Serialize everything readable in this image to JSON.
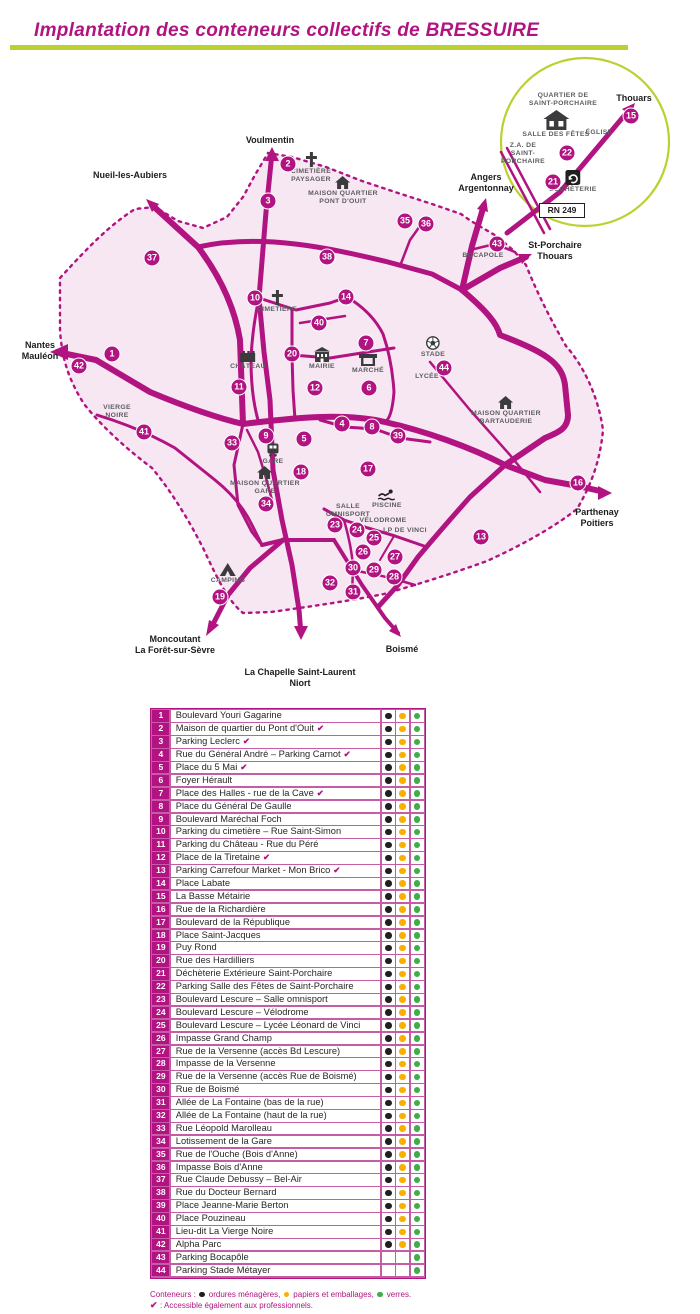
{
  "title": "Implantation des conteneurs collectifs de BRESSUIRE",
  "colors": {
    "magenta": "#b11380",
    "chartreuse": "#bcd02f",
    "pink": "#f6e7f2",
    "dot_black": "#231f20",
    "dot_yellow": "#f9b000",
    "dot_green": "#3fae49"
  },
  "map": {
    "markers": [
      {
        "n": 1,
        "x": 112,
        "y": 354
      },
      {
        "n": 2,
        "x": 288,
        "y": 164
      },
      {
        "n": 3,
        "x": 268,
        "y": 201
      },
      {
        "n": 4,
        "x": 342,
        "y": 424
      },
      {
        "n": 5,
        "x": 304,
        "y": 439
      },
      {
        "n": 6,
        "x": 369,
        "y": 388
      },
      {
        "n": 7,
        "x": 366,
        "y": 343
      },
      {
        "n": 8,
        "x": 372,
        "y": 427
      },
      {
        "n": 9,
        "x": 266,
        "y": 436
      },
      {
        "n": 10,
        "x": 255,
        "y": 298
      },
      {
        "n": 11,
        "x": 239,
        "y": 387
      },
      {
        "n": 12,
        "x": 315,
        "y": 388
      },
      {
        "n": 13,
        "x": 481,
        "y": 537
      },
      {
        "n": 14,
        "x": 346,
        "y": 297
      },
      {
        "n": 15,
        "x": 631,
        "y": 116
      },
      {
        "n": 16,
        "x": 578,
        "y": 483
      },
      {
        "n": 17,
        "x": 368,
        "y": 469
      },
      {
        "n": 18,
        "x": 301,
        "y": 472
      },
      {
        "n": 19,
        "x": 220,
        "y": 597
      },
      {
        "n": 20,
        "x": 292,
        "y": 354
      },
      {
        "n": 21,
        "x": 553,
        "y": 182
      },
      {
        "n": 22,
        "x": 567,
        "y": 153
      },
      {
        "n": 23,
        "x": 335,
        "y": 525
      },
      {
        "n": 24,
        "x": 357,
        "y": 530
      },
      {
        "n": 25,
        "x": 374,
        "y": 538
      },
      {
        "n": 26,
        "x": 363,
        "y": 552
      },
      {
        "n": 27,
        "x": 395,
        "y": 557
      },
      {
        "n": 28,
        "x": 394,
        "y": 577
      },
      {
        "n": 29,
        "x": 374,
        "y": 570
      },
      {
        "n": 30,
        "x": 353,
        "y": 568
      },
      {
        "n": 31,
        "x": 353,
        "y": 592
      },
      {
        "n": 32,
        "x": 330,
        "y": 583
      },
      {
        "n": 33,
        "x": 232,
        "y": 443
      },
      {
        "n": 34,
        "x": 266,
        "y": 504
      },
      {
        "n": 35,
        "x": 405,
        "y": 221
      },
      {
        "n": 36,
        "x": 426,
        "y": 224
      },
      {
        "n": 37,
        "x": 152,
        "y": 258
      },
      {
        "n": 38,
        "x": 327,
        "y": 257
      },
      {
        "n": 39,
        "x": 398,
        "y": 436
      },
      {
        "n": 40,
        "x": 319,
        "y": 323
      },
      {
        "n": 41,
        "x": 144,
        "y": 432
      },
      {
        "n": 42,
        "x": 79,
        "y": 366
      },
      {
        "n": 43,
        "x": 497,
        "y": 244
      },
      {
        "n": 44,
        "x": 444,
        "y": 368
      }
    ],
    "landmarks": [
      {
        "id": "cimetiere-paysager",
        "icon": "cross",
        "x": 311,
        "y": 151,
        "lines": [
          "CIMETIÈRE",
          "PAYSAGER"
        ]
      },
      {
        "id": "maison-quartier-pont-douit",
        "icon": "house",
        "x": 343,
        "y": 176,
        "lines": [
          "MAISON QUARTIER",
          "PONT D'OUIT"
        ]
      },
      {
        "id": "cimetiere",
        "icon": "cross",
        "x": 277,
        "y": 289,
        "lines": [
          "CIMETIÈRE"
        ]
      },
      {
        "id": "chateau",
        "icon": "castle",
        "x": 248,
        "y": 350,
        "lines": [
          "CHÂTEAU"
        ]
      },
      {
        "id": "mairie",
        "icon": "mairie",
        "x": 322,
        "y": 347,
        "lines": [
          "MAIRIE"
        ]
      },
      {
        "id": "marche",
        "icon": "market",
        "x": 368,
        "y": 353,
        "lines": [
          "MARCHÉ"
        ]
      },
      {
        "id": "stade",
        "icon": "ball",
        "x": 433,
        "y": 336,
        "lines": [
          "STADE"
        ]
      },
      {
        "id": "lycee",
        "x": 427,
        "y": 373,
        "lines": [
          "LYCÉE"
        ]
      },
      {
        "id": "maison-quartier-bartauderie",
        "icon": "house",
        "x": 506,
        "y": 396,
        "lines": [
          "MAISON QUARTIER",
          "BARTAUDERIE"
        ]
      },
      {
        "id": "gare",
        "icon": "train",
        "x": 273,
        "y": 442,
        "lines": [
          "GARE"
        ]
      },
      {
        "id": "maison-quartier-gare",
        "icon": "house",
        "x": 265,
        "y": 466,
        "lines": [
          "MAISON QUARTIER",
          "GARE"
        ]
      },
      {
        "id": "piscine",
        "icon": "swimmer",
        "x": 387,
        "y": 489,
        "lines": [
          "PISCINE"
        ]
      },
      {
        "id": "salle-omnisport",
        "x": 348,
        "y": 503,
        "lines": [
          "SALLE",
          "OMNISPORT"
        ]
      },
      {
        "id": "velodrome",
        "x": 383,
        "y": 517,
        "lines": [
          "VÉLODROME"
        ]
      },
      {
        "id": "lp-de-vinci",
        "x": 405,
        "y": 527,
        "lines": [
          "LP DE VINCI"
        ]
      },
      {
        "id": "camping",
        "icon": "tent",
        "x": 228,
        "y": 563,
        "lines": [
          "CAMPING"
        ]
      },
      {
        "id": "vierge-noire",
        "x": 117,
        "y": 404,
        "lines": [
          "VIERGE",
          "NOIRE"
        ]
      },
      {
        "id": "bocapole",
        "x": 483,
        "y": 252,
        "lines": [
          "BOCAPOLE"
        ]
      },
      {
        "id": "quartier-saint-porchaire",
        "x": 563,
        "y": 92,
        "lines": [
          "QUARTIER DE",
          "SAINT-PORCHAIRE"
        ]
      },
      {
        "id": "salle-des-fetes",
        "icon": "salle",
        "x": 556,
        "y": 110,
        "lines": [
          "SALLE DES FÊTES"
        ]
      },
      {
        "id": "eglise",
        "x": 599,
        "y": 129,
        "lines": [
          "ÉGLISE"
        ]
      },
      {
        "id": "za-saint-porchaire",
        "x": 523,
        "y": 142,
        "lines": [
          "Z.A. DE",
          "SAINT-",
          "PORCHAIRE"
        ]
      },
      {
        "id": "dechetterie",
        "icon": "recycle",
        "x": 573,
        "y": 170,
        "lines": [
          "DÉCHÈTERIE"
        ]
      }
    ],
    "destinations": [
      {
        "id": "voulmentin",
        "x": 270,
        "y": 135,
        "lines": [
          "Voulmentin"
        ]
      },
      {
        "id": "nueil-les-aubiers",
        "x": 130,
        "y": 170,
        "lines": [
          "Nueil-les-Aubiers"
        ]
      },
      {
        "id": "angers-argentonnay",
        "x": 486,
        "y": 172,
        "lines": [
          "Angers",
          "Argentonnay"
        ]
      },
      {
        "id": "st-porchaire-thouars",
        "x": 555,
        "y": 240,
        "lines": [
          "St-Porchaire",
          "Thouars"
        ]
      },
      {
        "id": "nantes-mauleon",
        "x": 40,
        "y": 340,
        "lines": [
          "Nantes",
          "Mauléon"
        ]
      },
      {
        "id": "parthenay-poitiers",
        "x": 597,
        "y": 507,
        "lines": [
          "Parthenay",
          "Poitiers"
        ]
      },
      {
        "id": "moncoutant",
        "x": 175,
        "y": 634,
        "lines": [
          "Moncoutant",
          "La Forêt-sur-Sèvre"
        ]
      },
      {
        "id": "la-chapelle-niort",
        "x": 300,
        "y": 667,
        "lines": [
          "La Chapelle Saint-Laurent",
          "Niort"
        ]
      },
      {
        "id": "boisme",
        "x": 402,
        "y": 644,
        "lines": [
          "Boismé"
        ]
      },
      {
        "id": "thouars-inset",
        "x": 634,
        "y": 93,
        "lines": [
          "Thouars"
        ]
      }
    ],
    "inset": {
      "rn": "RN 249"
    }
  },
  "table": {
    "rows": [
      {
        "n": 1,
        "name": "Boulevard Youri Gagarine",
        "pro": false,
        "om": true,
        "pe": true,
        "ve": true
      },
      {
        "n": 2,
        "name": "Maison de quartier du Pont d'Ouit",
        "pro": true,
        "om": true,
        "pe": true,
        "ve": true
      },
      {
        "n": 3,
        "name": "Parking Leclerc",
        "pro": true,
        "om": true,
        "pe": true,
        "ve": true
      },
      {
        "n": 4,
        "name": "Rue du Général André – Parking Carnot",
        "pro": true,
        "om": true,
        "pe": true,
        "ve": true
      },
      {
        "n": 5,
        "name": "Place du 5 Mai",
        "pro": true,
        "om": true,
        "pe": true,
        "ve": true
      },
      {
        "n": 6,
        "name": "Foyer Hérault",
        "pro": false,
        "om": true,
        "pe": true,
        "ve": true
      },
      {
        "n": 7,
        "name": "Place des Halles - rue de la Cave",
        "pro": true,
        "om": true,
        "pe": true,
        "ve": true
      },
      {
        "n": 8,
        "name": "Place du Général De Gaulle",
        "pro": false,
        "om": true,
        "pe": true,
        "ve": true
      },
      {
        "n": 9,
        "name": "Boulevard Maréchal Foch",
        "pro": false,
        "om": true,
        "pe": true,
        "ve": true
      },
      {
        "n": 10,
        "name": "Parking du cimetière – Rue Saint-Simon",
        "pro": false,
        "om": true,
        "pe": true,
        "ve": true
      },
      {
        "n": 11,
        "name": "Parking du Château - Rue du Péré",
        "pro": false,
        "om": true,
        "pe": true,
        "ve": true
      },
      {
        "n": 12,
        "name": "Place de la Tiretaine",
        "pro": true,
        "om": true,
        "pe": true,
        "ve": true
      },
      {
        "n": 13,
        "name": "Parking Carrefour Market - Mon Brico",
        "pro": true,
        "om": true,
        "pe": true,
        "ve": true
      },
      {
        "n": 14,
        "name": "Place Labate",
        "pro": false,
        "om": true,
        "pe": true,
        "ve": true
      },
      {
        "n": 15,
        "name": "La Basse Métairie",
        "pro": false,
        "om": true,
        "pe": true,
        "ve": true
      },
      {
        "n": 16,
        "name": "Rue de la Richardière",
        "pro": false,
        "om": true,
        "pe": true,
        "ve": true
      },
      {
        "n": 17,
        "name": "Boulevard de la République",
        "pro": false,
        "om": true,
        "pe": true,
        "ve": true
      },
      {
        "n": 18,
        "name": "Place Saint-Jacques",
        "pro": false,
        "om": true,
        "pe": true,
        "ve": true
      },
      {
        "n": 19,
        "name": "Puy Rond",
        "pro": false,
        "om": true,
        "pe": true,
        "ve": true
      },
      {
        "n": 20,
        "name": "Rue des Hardilliers",
        "pro": false,
        "om": true,
        "pe": true,
        "ve": true
      },
      {
        "n": 21,
        "name": "Déchèterie Extérieure Saint-Porchaire",
        "pro": false,
        "om": true,
        "pe": true,
        "ve": true
      },
      {
        "n": 22,
        "name": "Parking Salle des Fêtes de Saint-Porchaire",
        "pro": false,
        "om": true,
        "pe": true,
        "ve": true
      },
      {
        "n": 23,
        "name": "Boulevard Lescure – Salle omnisport",
        "pro": false,
        "om": true,
        "pe": true,
        "ve": true
      },
      {
        "n": 24,
        "name": "Boulevard Lescure – Vélodrome",
        "pro": false,
        "om": true,
        "pe": true,
        "ve": true
      },
      {
        "n": 25,
        "name": "Boulevard Lescure – Lycée Léonard de Vinci",
        "pro": false,
        "om": true,
        "pe": true,
        "ve": true
      },
      {
        "n": 26,
        "name": "Impasse Grand Champ",
        "pro": false,
        "om": true,
        "pe": true,
        "ve": true
      },
      {
        "n": 27,
        "name": "Rue de la Versenne (accès Bd Lescure)",
        "pro": false,
        "om": true,
        "pe": true,
        "ve": true
      },
      {
        "n": 28,
        "name": "Impasse de la Versenne",
        "pro": false,
        "om": true,
        "pe": true,
        "ve": true
      },
      {
        "n": 29,
        "name": "Rue de la Versenne (accès Rue de Boismé)",
        "pro": false,
        "om": true,
        "pe": true,
        "ve": true
      },
      {
        "n": 30,
        "name": "Rue de Boismé",
        "pro": false,
        "om": true,
        "pe": true,
        "ve": true
      },
      {
        "n": 31,
        "name": "Allée de La Fontaine (bas de la rue)",
        "pro": false,
        "om": true,
        "pe": true,
        "ve": true
      },
      {
        "n": 32,
        "name": "Allée de La Fontaine (haut de la rue)",
        "pro": false,
        "om": true,
        "pe": true,
        "ve": true
      },
      {
        "n": 33,
        "name": "Rue Léopold Marolleau",
        "pro": false,
        "om": true,
        "pe": true,
        "ve": true
      },
      {
        "n": 34,
        "name": "Lotissement de la Gare",
        "pro": false,
        "om": true,
        "pe": true,
        "ve": true
      },
      {
        "n": 35,
        "name": "Rue de l'Ouche (Bois d'Anne)",
        "pro": false,
        "om": true,
        "pe": true,
        "ve": true
      },
      {
        "n": 36,
        "name": "Impasse Bois d'Anne",
        "pro": false,
        "om": true,
        "pe": true,
        "ve": true
      },
      {
        "n": 37,
        "name": "Rue Claude Debussy – Bel-Air",
        "pro": false,
        "om": true,
        "pe": true,
        "ve": true
      },
      {
        "n": 38,
        "name": "Rue du Docteur Bernard",
        "pro": false,
        "om": true,
        "pe": true,
        "ve": true
      },
      {
        "n": 39,
        "name": "Place Jeanne-Marie Berton",
        "pro": false,
        "om": true,
        "pe": true,
        "ve": true
      },
      {
        "n": 40,
        "name": "Place Pouzineau",
        "pro": false,
        "om": true,
        "pe": true,
        "ve": true
      },
      {
        "n": 41,
        "name": "Lieu-dit La Vierge Noire",
        "pro": false,
        "om": true,
        "pe": true,
        "ve": true
      },
      {
        "n": 42,
        "name": "Alpha Parc",
        "pro": false,
        "om": true,
        "pe": true,
        "ve": true
      },
      {
        "n": 43,
        "name": "Parking Bocapôle",
        "pro": false,
        "om": false,
        "pe": false,
        "ve": true
      },
      {
        "n": 44,
        "name": "Parking Stade Métayer",
        "pro": false,
        "om": false,
        "pe": false,
        "ve": true
      }
    ],
    "check_symbol": "✔"
  },
  "legend": {
    "prefix": "Conteneurs :",
    "items": [
      {
        "dot": "black",
        "label": "ordures ménagères,"
      },
      {
        "dot": "yellow",
        "label": "papiers et emballages,"
      },
      {
        "dot": "green",
        "label": "verres."
      }
    ],
    "pro_symbol": "✔",
    "pro_text": ": Accessible également aux professionnels."
  }
}
